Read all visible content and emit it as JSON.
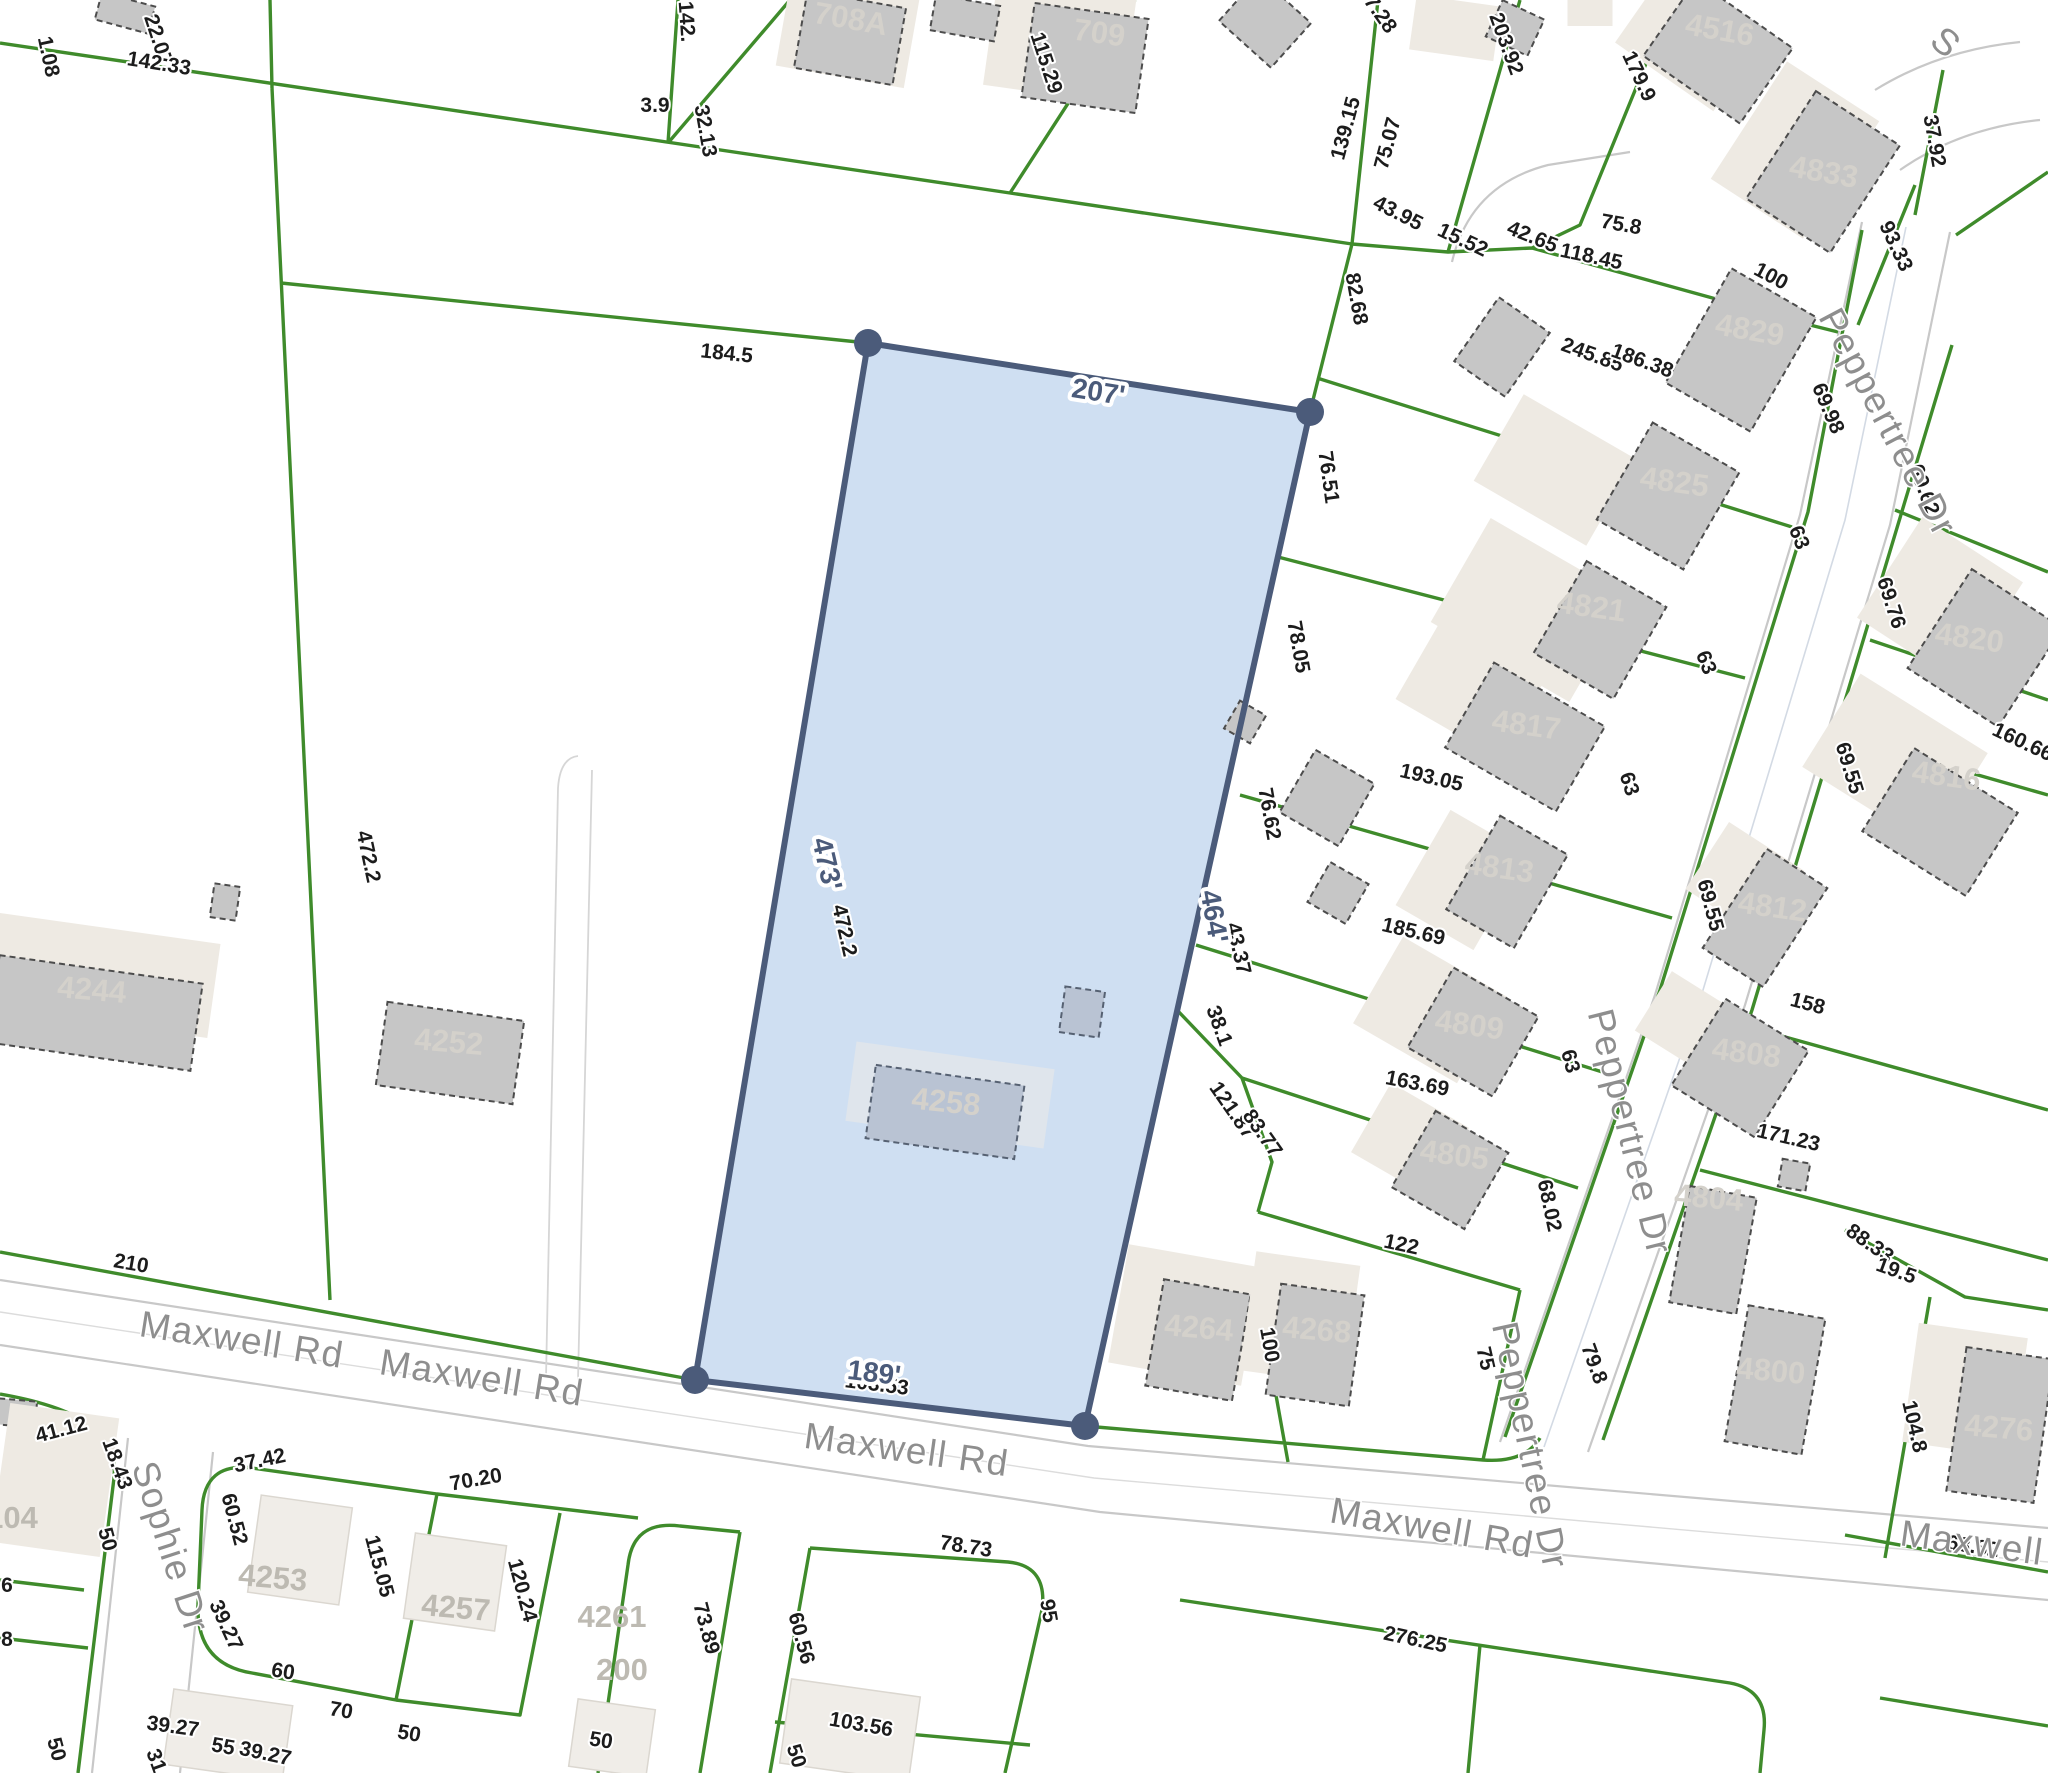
{
  "app": {
    "type": "parcel-map-viewer"
  },
  "colors": {
    "parcel_green": "#3f8b2b",
    "highlight_fill": "#cfdff2",
    "highlight_stroke": "#4b5b7a",
    "building_fill": "#c6c6c6",
    "building_outline": "#4c4c4c",
    "building_shadow": "#eeeae3",
    "dim_text": "#1c1c1c",
    "street_text": "#8e8e8e",
    "parcel_number_text": "#d4d1cb",
    "road_edge": "#c8c8c8"
  },
  "highlighted_parcel": {
    "building_number": "4258",
    "dimensions": [
      {
        "t": "207'",
        "x": 1097,
        "y": 401,
        "r": 9
      },
      {
        "t": "473'",
        "x": 818,
        "y": 866,
        "r": 77
      },
      {
        "t": "464'",
        "x": 1205,
        "y": 918,
        "r": 80
      },
      {
        "t": "189'",
        "x": 873,
        "y": 1382,
        "r": 7
      }
    ]
  },
  "streets": [
    {
      "name": "Maxwell Rd",
      "x": 240,
      "y": 1352,
      "r": 9
    },
    {
      "name": "Maxwell Rd",
      "x": 480,
      "y": 1390,
      "r": 9
    },
    {
      "name": "Maxwell Rd",
      "x": 905,
      "y": 1462,
      "r": 8
    },
    {
      "name": "Maxwell Rd",
      "x": 1430,
      "y": 1540,
      "r": 10
    },
    {
      "name": "Maxwell R",
      "x": 1990,
      "y": 1558,
      "r": 8
    },
    {
      "name": "Peppertree Dr",
      "x": 1877,
      "y": 428,
      "r": 62
    },
    {
      "name": "Peppertree Dr",
      "x": 1618,
      "y": 1135,
      "r": 76
    },
    {
      "name": "Peppertree Dr",
      "x": 1518,
      "y": 1448,
      "r": 78
    },
    {
      "name": "Sophie Dr",
      "x": 159,
      "y": 1551,
      "r": 72
    },
    {
      "name": "S",
      "x": 1938,
      "y": 52,
      "r": 40
    }
  ],
  "parcel_numbers": [
    {
      "t": "708A",
      "x": 849,
      "y": 29,
      "r": 10,
      "k": "pnum"
    },
    {
      "t": "709",
      "x": 1098,
      "y": 43,
      "r": 8,
      "k": "pnum"
    },
    {
      "t": "4516",
      "x": 1718,
      "y": 40,
      "r": 10,
      "k": "pnum"
    },
    {
      "t": "4833",
      "x": 1822,
      "y": 182,
      "r": 10,
      "k": "pnum"
    },
    {
      "t": "4829",
      "x": 1748,
      "y": 340,
      "r": 10,
      "k": "pnum"
    },
    {
      "t": "4825",
      "x": 1673,
      "y": 492,
      "r": 8,
      "k": "pnum"
    },
    {
      "t": "4821",
      "x": 1590,
      "y": 617,
      "r": 8,
      "k": "pnum"
    },
    {
      "t": "4820",
      "x": 1968,
      "y": 648,
      "r": 8,
      "k": "pnum"
    },
    {
      "t": "4817",
      "x": 1525,
      "y": 735,
      "r": 8,
      "k": "pnum"
    },
    {
      "t": "4816",
      "x": 1945,
      "y": 786,
      "r": 8,
      "k": "pnum"
    },
    {
      "t": "4813",
      "x": 1498,
      "y": 878,
      "r": 8,
      "k": "pnum"
    },
    {
      "t": "4812",
      "x": 1771,
      "y": 917,
      "r": 8,
      "k": "pnum"
    },
    {
      "t": "4809",
      "x": 1468,
      "y": 1035,
      "r": 8,
      "k": "pnum"
    },
    {
      "t": "4808",
      "x": 1745,
      "y": 1063,
      "r": 8,
      "k": "pnum"
    },
    {
      "t": "4805",
      "x": 1453,
      "y": 1165,
      "r": 8,
      "k": "pnum"
    },
    {
      "t": "4804",
      "x": 1708,
      "y": 1208,
      "r": 5,
      "k": "pnum"
    },
    {
      "t": "4800",
      "x": 1770,
      "y": 1381,
      "r": 5,
      "k": "pnum"
    },
    {
      "t": "4276",
      "x": 1998,
      "y": 1438,
      "r": 5,
      "k": "pnum"
    },
    {
      "t": "4264",
      "x": 1198,
      "y": 1338,
      "r": 5,
      "k": "pnum"
    },
    {
      "t": "4268",
      "x": 1316,
      "y": 1340,
      "r": 5,
      "k": "pnum"
    },
    {
      "t": "4258",
      "x": 945,
      "y": 1112,
      "r": 6,
      "k": "pnum"
    },
    {
      "t": "4252",
      "x": 448,
      "y": 1052,
      "r": 5,
      "k": "pnum"
    },
    {
      "t": "4244",
      "x": 91,
      "y": 1000,
      "r": 5,
      "k": "pnum"
    },
    {
      "t": "4253",
      "x": 272,
      "y": 1588,
      "r": 5,
      "k": "pnum2"
    },
    {
      "t": "4257",
      "x": 455,
      "y": 1618,
      "r": 5,
      "k": "pnum2"
    },
    {
      "t": "4261",
      "x": 612,
      "y": 1627,
      "r": 0,
      "k": "pnum2"
    },
    {
      "t": "200",
      "x": 622,
      "y": 1680,
      "r": 0,
      "k": "pnum2"
    },
    {
      "t": "104",
      "x": 12,
      "y": 1528,
      "r": 0,
      "k": "pnum2"
    }
  ],
  "dimensions": [
    {
      "t": "1.08",
      "x": 42,
      "y": 58,
      "r": 78
    },
    {
      "t": "22.07",
      "x": 152,
      "y": 42,
      "r": 72
    },
    {
      "t": "142.33",
      "x": 158,
      "y": 70,
      "r": 9
    },
    {
      "t": "142.",
      "x": 680,
      "y": 22,
      "r": 86
    },
    {
      "t": "3.9",
      "x": 655,
      "y": 112,
      "r": 0
    },
    {
      "t": "32.13",
      "x": 699,
      "y": 132,
      "r": 80
    },
    {
      "t": "184.5",
      "x": 726,
      "y": 360,
      "r": 6
    },
    {
      "t": "115.29",
      "x": 1040,
      "y": 65,
      "r": 72
    },
    {
      "t": "7.28",
      "x": 1375,
      "y": 18,
      "r": 55
    },
    {
      "t": "139.15",
      "x": 1352,
      "y": 130,
      "r": -75
    },
    {
      "t": "75.07",
      "x": 1394,
      "y": 145,
      "r": -75
    },
    {
      "t": "203.92",
      "x": 1500,
      "y": 46,
      "r": 70
    },
    {
      "t": "179.9",
      "x": 1633,
      "y": 79,
      "r": 65
    },
    {
      "t": "37.92",
      "x": 1928,
      "y": 142,
      "r": 80
    },
    {
      "t": "43.95",
      "x": 1395,
      "y": 219,
      "r": 27
    },
    {
      "t": "15.52",
      "x": 1460,
      "y": 246,
      "r": 25
    },
    {
      "t": "42.65",
      "x": 1530,
      "y": 243,
      "r": 22
    },
    {
      "t": "118.45",
      "x": 1590,
      "y": 263,
      "r": 12
    },
    {
      "t": "75.8",
      "x": 1620,
      "y": 231,
      "r": 10
    },
    {
      "t": "93.33",
      "x": 1890,
      "y": 249,
      "r": 65
    },
    {
      "t": "100",
      "x": 1768,
      "y": 282,
      "r": 28
    },
    {
      "t": "82.68",
      "x": 1350,
      "y": 300,
      "r": 80
    },
    {
      "t": "245.85",
      "x": 1590,
      "y": 361,
      "r": 20
    },
    {
      "t": "186.38",
      "x": 1640,
      "y": 367,
      "r": 20
    },
    {
      "t": "69.98",
      "x": 1822,
      "y": 411,
      "r": 67
    },
    {
      "t": "69.62",
      "x": 1918,
      "y": 492,
      "r": 70
    },
    {
      "t": "63",
      "x": 1793,
      "y": 540,
      "r": 68
    },
    {
      "t": "76.51",
      "x": 1322,
      "y": 478,
      "r": 82
    },
    {
      "t": "63",
      "x": 1700,
      "y": 665,
      "r": 68
    },
    {
      "t": "69.76",
      "x": 1885,
      "y": 605,
      "r": 72
    },
    {
      "t": "78.05",
      "x": 1292,
      "y": 648,
      "r": 80
    },
    {
      "t": "63",
      "x": 1623,
      "y": 786,
      "r": 72
    },
    {
      "t": "193.05",
      "x": 1430,
      "y": 784,
      "r": 13
    },
    {
      "t": "76.62",
      "x": 1263,
      "y": 815,
      "r": 80
    },
    {
      "t": "69.55",
      "x": 1843,
      "y": 770,
      "r": 73
    },
    {
      "t": "160.66",
      "x": 2020,
      "y": 748,
      "r": 25
    },
    {
      "t": "185.69",
      "x": 1412,
      "y": 938,
      "r": 13
    },
    {
      "t": "69.55",
      "x": 1704,
      "y": 907,
      "r": 75
    },
    {
      "t": "43.37",
      "x": 1232,
      "y": 950,
      "r": 77
    },
    {
      "t": "158",
      "x": 1806,
      "y": 1010,
      "r": 15
    },
    {
      "t": "63",
      "x": 1564,
      "y": 1063,
      "r": 75
    },
    {
      "t": "38.1",
      "x": 1213,
      "y": 1028,
      "r": 70
    },
    {
      "t": "121.87",
      "x": 1227,
      "y": 1114,
      "r": 55
    },
    {
      "t": "83.77",
      "x": 1257,
      "y": 1137,
      "r": 55
    },
    {
      "t": "163.69",
      "x": 1416,
      "y": 1090,
      "r": 11
    },
    {
      "t": "122",
      "x": 1400,
      "y": 1251,
      "r": 12
    },
    {
      "t": "68.02",
      "x": 1543,
      "y": 1207,
      "r": 78
    },
    {
      "t": "171.23",
      "x": 1787,
      "y": 1144,
      "r": 13
    },
    {
      "t": "88.33",
      "x": 1866,
      "y": 1249,
      "r": 35
    },
    {
      "t": "19.5",
      "x": 1894,
      "y": 1277,
      "r": 20
    },
    {
      "t": "104.8",
      "x": 1908,
      "y": 1428,
      "r": 77
    },
    {
      "t": "68.82",
      "x": 1972,
      "y": 1553,
      "r": 9
    },
    {
      "t": "79.8",
      "x": 1588,
      "y": 1366,
      "r": 70
    },
    {
      "t": "75",
      "x": 1479,
      "y": 1360,
      "r": 77
    },
    {
      "t": "100",
      "x": 1263,
      "y": 1346,
      "r": 80
    },
    {
      "t": "276.25",
      "x": 1414,
      "y": 1646,
      "r": 12
    },
    {
      "t": "210",
      "x": 130,
      "y": 1270,
      "r": 10
    },
    {
      "t": "472.2",
      "x": 362,
      "y": 858,
      "r": 78
    },
    {
      "t": "472.2",
      "x": 838,
      "y": 932,
      "r": 77
    },
    {
      "t": "103.53",
      "x": 876,
      "y": 1391,
      "r": 7
    },
    {
      "t": "41.12",
      "x": 63,
      "y": 1436,
      "r": -15
    },
    {
      "t": "18.43",
      "x": 111,
      "y": 1466,
      "r": 70
    },
    {
      "t": "50",
      "x": 101,
      "y": 1541,
      "r": 75
    },
    {
      "t": "37.42",
      "x": 261,
      "y": 1467,
      "r": -12
    },
    {
      "t": "60.52",
      "x": 228,
      "y": 1521,
      "r": 75
    },
    {
      "t": "39.27",
      "x": 220,
      "y": 1628,
      "r": 65
    },
    {
      "t": "115.05",
      "x": 373,
      "y": 1568,
      "r": 75
    },
    {
      "t": "70.20",
      "x": 477,
      "y": 1486,
      "r": -10
    },
    {
      "t": "120.24",
      "x": 516,
      "y": 1592,
      "r": 75
    },
    {
      "t": "60",
      "x": 282,
      "y": 1678,
      "r": 9
    },
    {
      "t": "70",
      "x": 340,
      "y": 1717,
      "r": 10
    },
    {
      "t": "50",
      "x": 408,
      "y": 1740,
      "r": 10
    },
    {
      "t": "39.27",
      "x": 172,
      "y": 1733,
      "r": 8
    },
    {
      "t": "55",
      "x": 222,
      "y": 1753,
      "r": 10
    },
    {
      "t": "39.27",
      "x": 264,
      "y": 1760,
      "r": 12
    },
    {
      "t": "31",
      "x": 150,
      "y": 1763,
      "r": 70
    },
    {
      "t": "50",
      "x": 50,
      "y": 1751,
      "r": 75
    },
    {
      "t": "103.56",
      "x": 860,
      "y": 1731,
      "r": 10
    },
    {
      "t": "60.56",
      "x": 795,
      "y": 1640,
      "r": 75
    },
    {
      "t": "73.89",
      "x": 700,
      "y": 1630,
      "r": 75
    },
    {
      "t": "78.73",
      "x": 965,
      "y": 1553,
      "r": 9
    },
    {
      "t": "95",
      "x": 1042,
      "y": 1612,
      "r": 80
    },
    {
      "t": "50",
      "x": 600,
      "y": 1747,
      "r": 9
    },
    {
      "t": "50",
      "x": 790,
      "y": 1758,
      "r": 72
    },
    {
      "t": "6",
      "x": 7,
      "y": 1592,
      "r": 0
    },
    {
      "t": "8",
      "x": 7,
      "y": 1646,
      "r": 0
    }
  ]
}
